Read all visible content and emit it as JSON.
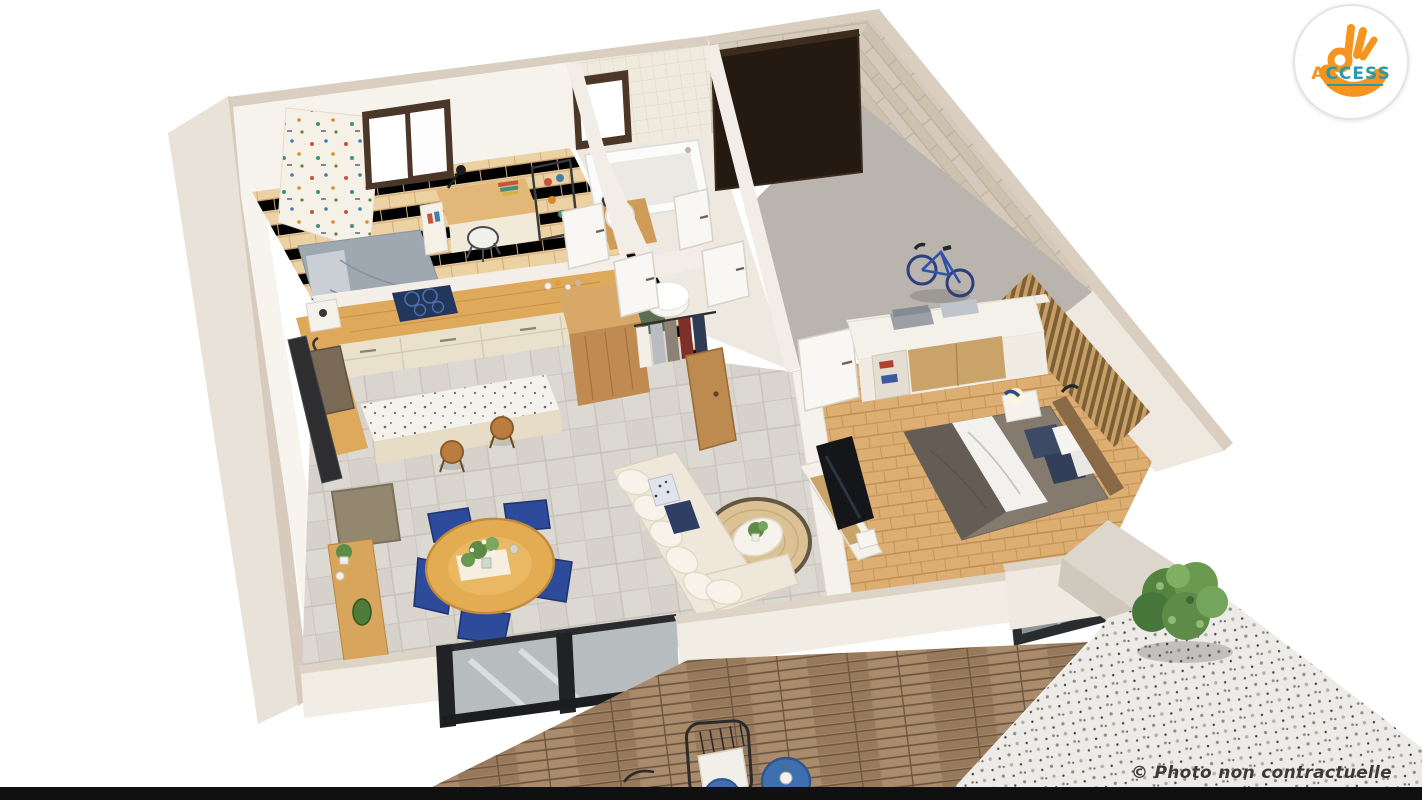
{
  "canvas": {
    "width": 1422,
    "height": 800,
    "background": "#ffffff",
    "bottom_bar_color": "#101010"
  },
  "branding": {
    "logo_text_accent": "A",
    "logo_text_rest": "CCESS",
    "logo_full_name": "ACCESS",
    "colors": {
      "orange": "#F5941F",
      "teal": "#2999AE",
      "circle_bg": "#FFFFFF",
      "ring": "#E6E4E1"
    }
  },
  "watermark": {
    "text": "© Photo non contractuelle",
    "color": "#3B3A36"
  },
  "scene": {
    "description": "3D cutaway floor plan render of a single-storey house viewed from above",
    "rooms": [
      "children-bedroom-office",
      "kitchen",
      "bathroom",
      "wc",
      "hallway",
      "walk-in-closet",
      "garage",
      "master-bedroom",
      "living-room",
      "dining-area",
      "terrace-deck",
      "gravel-patio"
    ],
    "palette": {
      "wall_white": "#F6F3ED",
      "wall_cut_top": "#D9CEC0",
      "stone_wall": "#D4CABC",
      "wood_floor_light": "#ECD2A2",
      "wood_floor_bedroom": "#DCAE72",
      "tile_floor": "#DCD8D2",
      "garage_floor": "#B9B4AE",
      "garage_door": "#251A11",
      "window_frame": "#4B3627",
      "kitchen_counter": "#DFA95B",
      "cooktop": "#23365C",
      "cabinet_cream": "#EAE1CC",
      "dining_chair_blue": "#2D4A9B",
      "dining_table": "#E3AC52",
      "sofa_cream": "#EFE8DA",
      "rug_jute": "#DBC294",
      "bed_duvet": "#847A6E",
      "pillow_navy": "#3D4A66",
      "deck_wood": "#A5876A",
      "gravel": "#EDEBE7",
      "shrub_green": "#5D8C48",
      "bike_blue": "#3053A8"
    }
  }
}
